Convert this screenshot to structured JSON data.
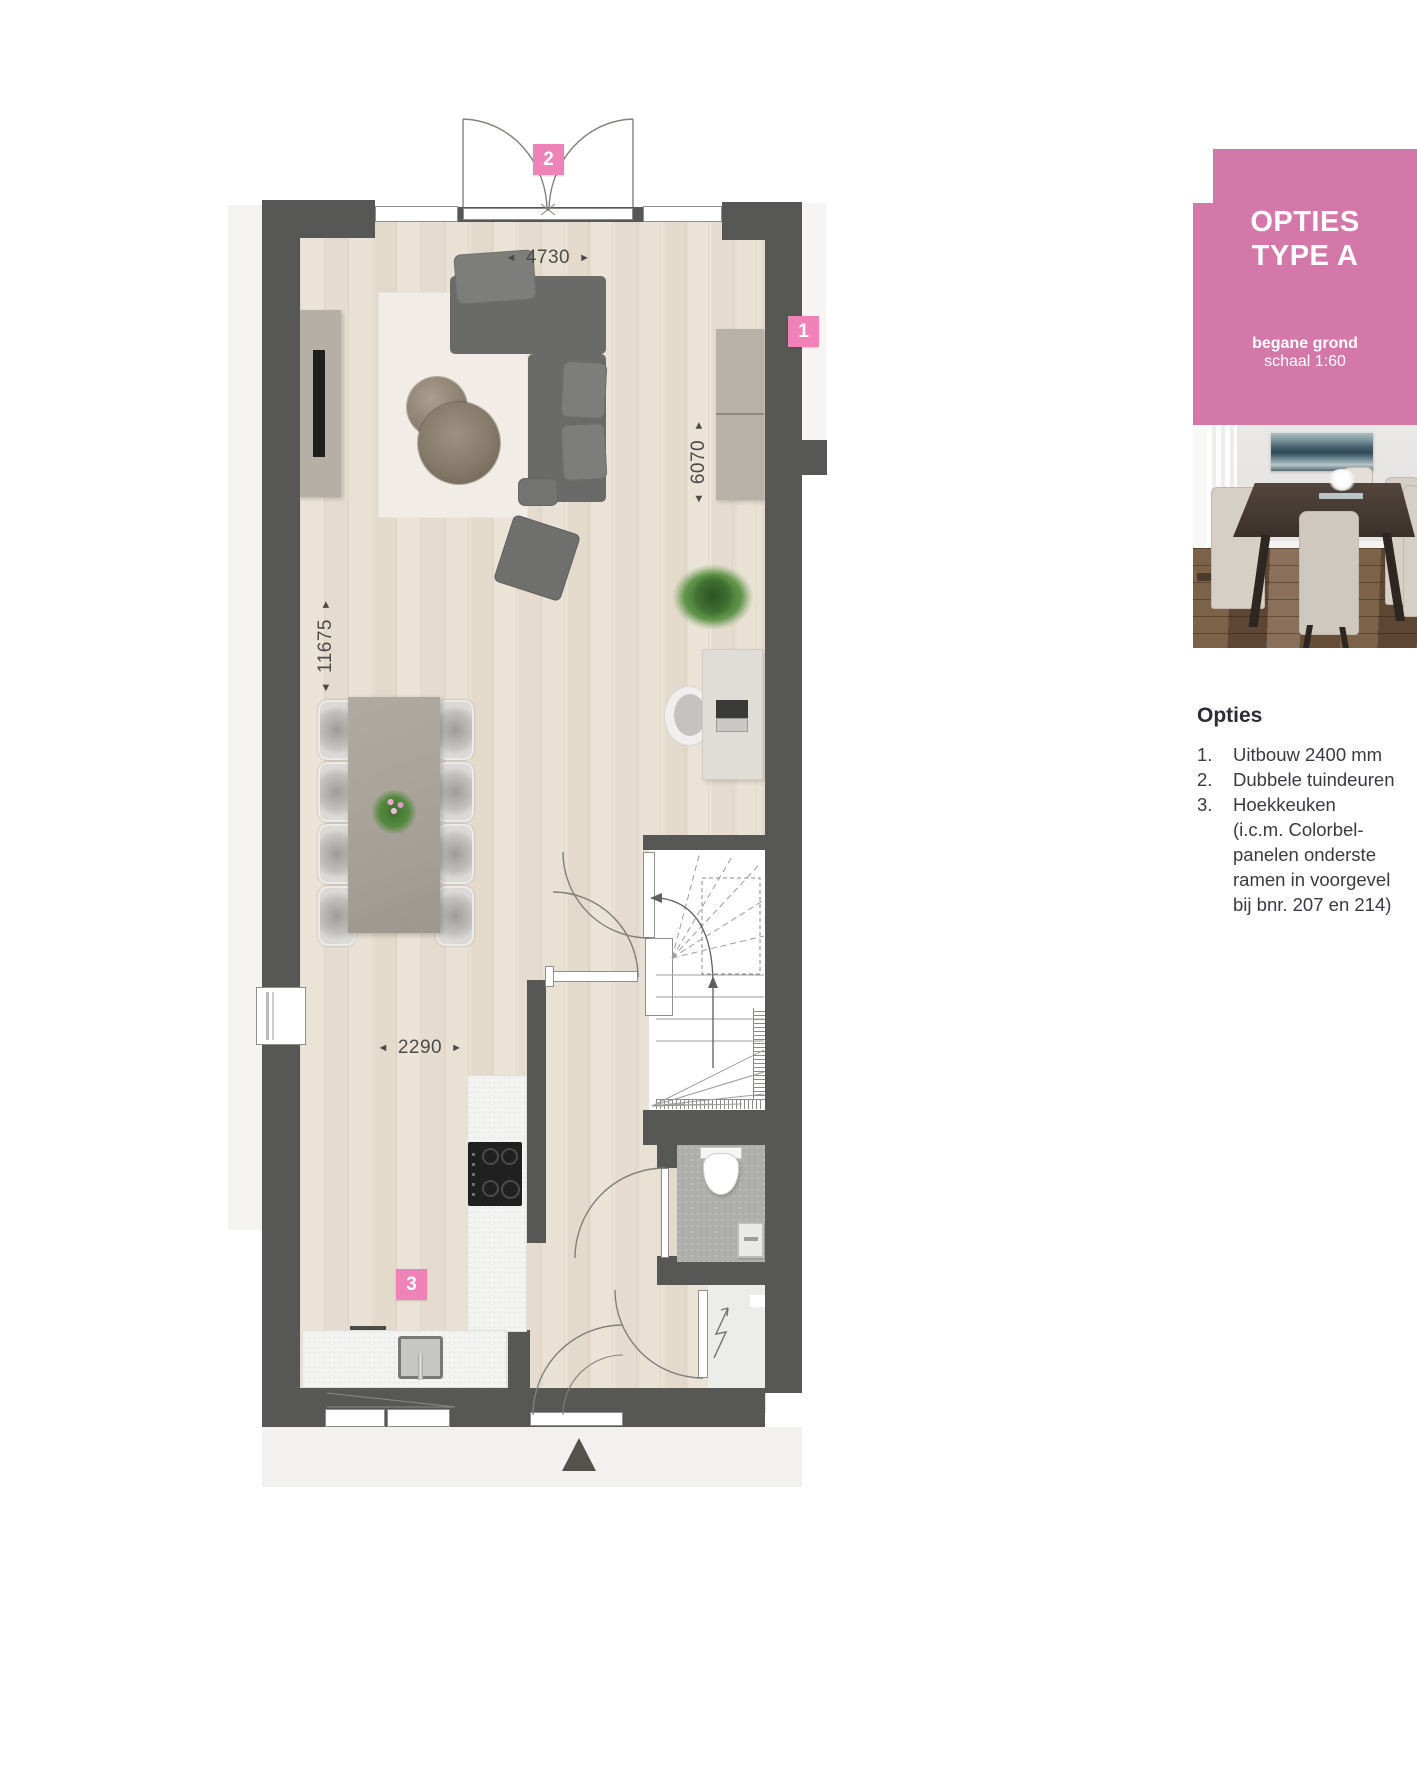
{
  "panel": {
    "title_line1": "OPTIES",
    "title_line2": "TYPE A",
    "meta_bold": "begane grond",
    "meta": "schaal 1:60"
  },
  "options": {
    "heading": "Opties",
    "items": [
      {
        "num": "1.",
        "lines": [
          "Uitbouw 2400 mm"
        ]
      },
      {
        "num": "2.",
        "lines": [
          "Dubbele tuindeuren"
        ]
      },
      {
        "num": "3.",
        "lines": [
          "Hoekkeuken",
          "(i.c.m. Colorbel-",
          "panelen onderste",
          "ramen in voorgevel",
          "bij bnr. 207 en 214)"
        ]
      }
    ]
  },
  "badges": {
    "one": "1",
    "two": "2",
    "three": "3"
  },
  "dimensions": {
    "top": {
      "value": "4730",
      "left_arrow": "◄",
      "right_arrow": "►"
    },
    "right": {
      "value": "6070",
      "left_arrow": "◄",
      "right_arrow": "►"
    },
    "left": {
      "value": "11675",
      "left_arrow": "◄",
      "right_arrow": "►"
    },
    "kitchen": {
      "value": "2290",
      "left_arrow": "◄",
      "right_arrow": "►"
    }
  },
  "colors": {
    "pink_panel": "#d478aa",
    "pink_badge": "#ef82b6",
    "wall": "#575756",
    "wood_floor": "#e9e0d4",
    "dimension_text": "#4b4b4a"
  }
}
